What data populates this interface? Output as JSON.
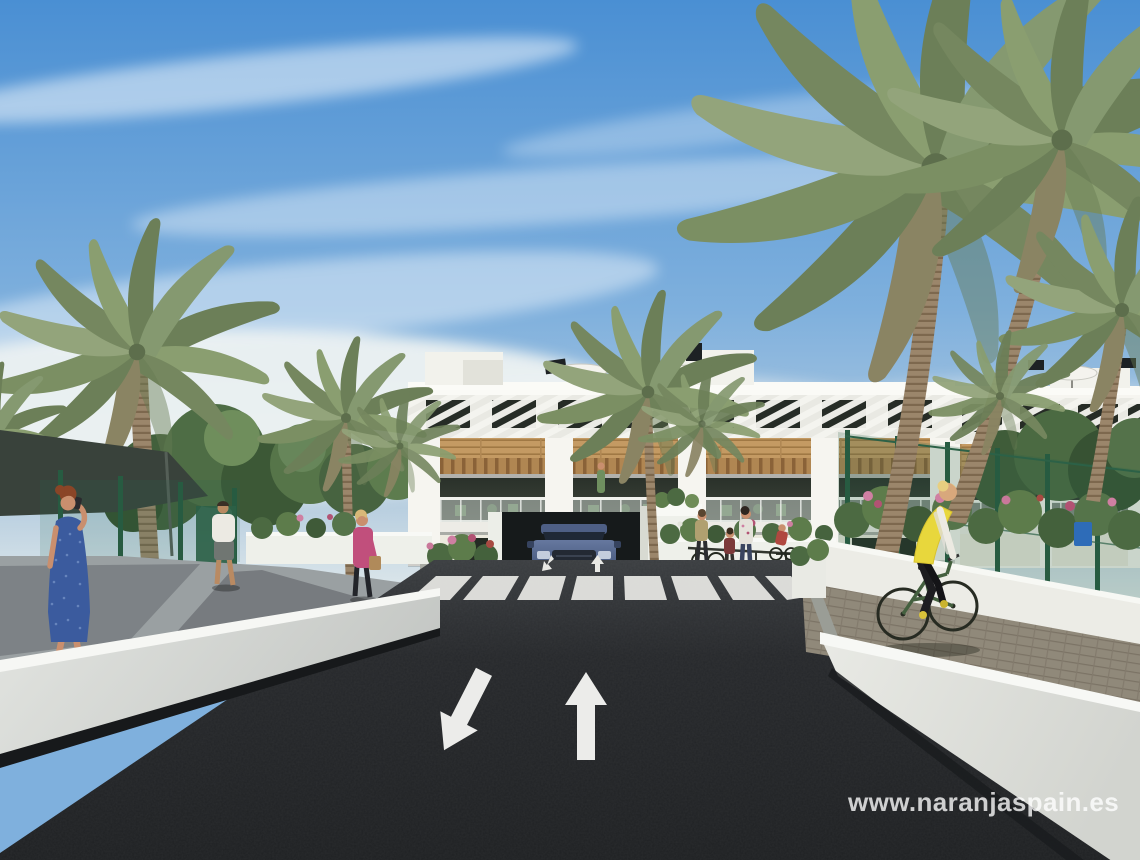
{
  "watermark": {
    "text": "www.naranjaspain.es"
  },
  "scene": {
    "description": "Architectural 3D render of a new-build white apartment complex with wood-slat pergolas, balconies, palm trees, a dark asphalt access road with two-way lane arrows and a zebra crossing, an underground garage with a car exiting, pedestrians and a cyclist in yellow.",
    "elements": [
      "sky",
      "clouds",
      "apartment-building",
      "roof-parasols",
      "wood-cladding-band",
      "balconies",
      "underground-garage",
      "car",
      "zebra-crossing",
      "lane-arrow-up",
      "lane-arrow-down-left",
      "left-retaining-wall",
      "right-retaining-wall",
      "paver-sidewalk",
      "green-mesh-fence",
      "palm-trees",
      "garden-flowers",
      "pedestrian-blue-dress",
      "pedestrian-white-shirt",
      "pedestrian-pink-jacket",
      "family-with-bikes",
      "cyclist-yellow-vest",
      "watermark-url"
    ],
    "road_markings": [
      "straight-ahead arrow",
      "diagonal down-left arrow",
      "zebra crossing stripes"
    ]
  },
  "palette": {
    "sky_top": "#4a8fd3",
    "sky_mid": "#7fb0dd",
    "sky_low": "#b9cfe0",
    "sky_horizon": "#e9efee",
    "asphalt": "#26282b",
    "asphalt_light": "#3a3d40",
    "marking_white": "#efefec",
    "wall_light": "#eef0ec",
    "wall_shadow": "#c7c9c6",
    "sidewalk_grey": "#9aa0a2",
    "paver": "#90897a",
    "building_white": "#f6f5f0",
    "wood": "#c49a63",
    "wood_dark": "#a07844",
    "window_dark": "#262c26",
    "balcony_glass": "#ccd5cf",
    "fence_green": "#2e6247",
    "foliage_dark": "#3f5a38",
    "foliage_mid": "#5d7c4b",
    "palm_green": "#7b8f63",
    "trunk_brown": "#9b866b",
    "flower_pink": "#c9789a",
    "car_blue": "#55688f",
    "vest_yellow": "#e8d73c",
    "dress_blue": "#3b5b9e",
    "jacket_pink": "#c14f7c",
    "skin": "#c98f6e",
    "shade_sail": "#39423b"
  }
}
